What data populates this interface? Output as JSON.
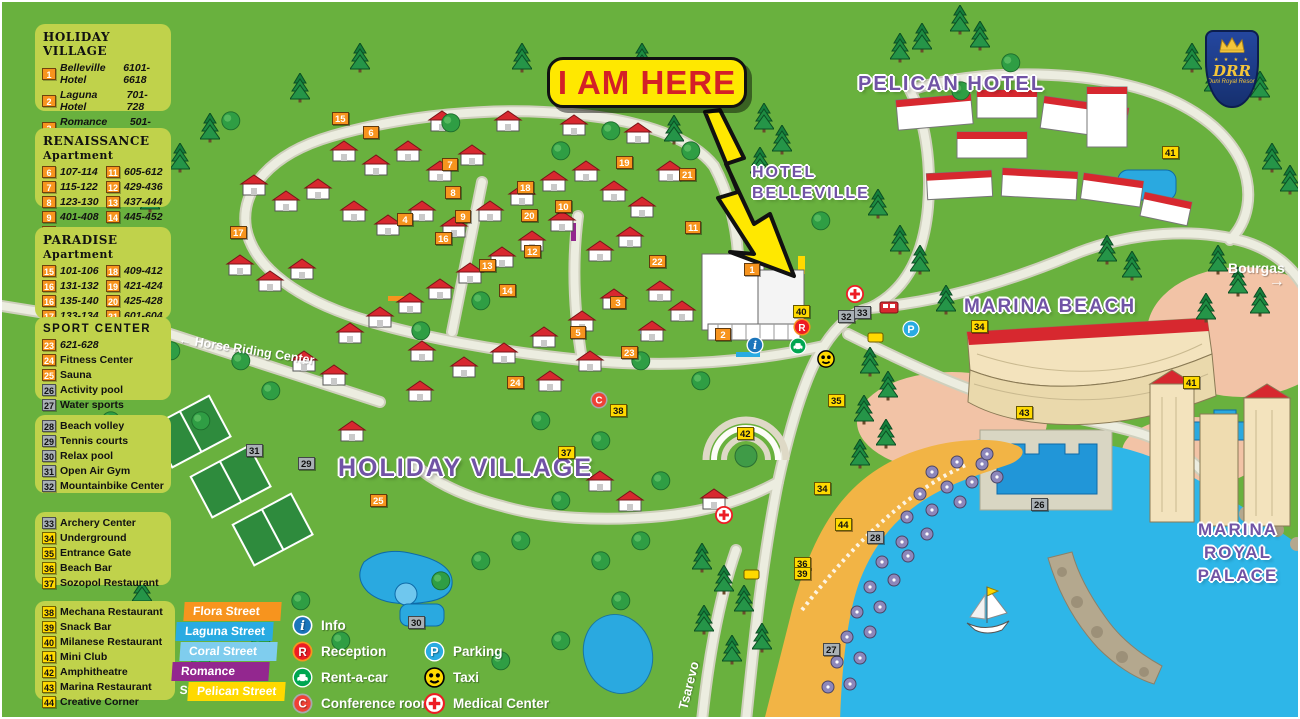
{
  "callout": {
    "text": "I AM HERE"
  },
  "logo": {
    "monogram": "DRR",
    "name": "Duni Royal Resort"
  },
  "colors": {
    "map_green": "#69b13e",
    "panel_bg": "#c0d24b",
    "badge_orange": "#f7941e",
    "badge_yellow": "#ffd900",
    "badge_gray": "#a9b0b5",
    "label_purple": "#7153a5",
    "sea": "#2eb6e8",
    "beach": "#f2b445"
  },
  "legend": {
    "panels": [
      {
        "id": "holiday-village",
        "box": {
          "x": 33,
          "y": 22,
          "w": 136,
          "h": 87
        },
        "title": "HOLIDAY VILLAGE",
        "serif": true,
        "columns": [
          [
            {
              "n": "1",
              "b": "o",
              "t": "Belleville Hotel",
              "v": "6101-6618",
              "i": 1
            },
            {
              "n": "2",
              "b": "o",
              "t": "Laguna Hotel",
              "v": "701-728",
              "i": 1
            },
            {
              "n": "3",
              "b": "o",
              "t": "Romance Hotel",
              "v": "501-554",
              "i": 1
            },
            {
              "n": "4",
              "b": "o",
              "t": "Flora Hotel",
              "v": "301-332",
              "i": 1
            },
            {
              "n": "5",
              "b": "o",
              "t": "Coral Hotel",
              "v": "201-251",
              "i": 1
            }
          ]
        ]
      },
      {
        "id": "renaissance-apartment",
        "box": {
          "x": 33,
          "y": 126,
          "w": 136,
          "h": 79
        },
        "title": "RENAISSANCE",
        "subtitle": "Apartment",
        "serif": true,
        "columns": [
          [
            {
              "n": "6",
              "b": "o",
              "t": "107-114",
              "i": 1
            },
            {
              "n": "7",
              "b": "o",
              "t": "115-122",
              "i": 1
            },
            {
              "n": "8",
              "b": "o",
              "t": "123-130",
              "i": 1
            },
            {
              "n": "9",
              "b": "o",
              "t": "401-408",
              "i": 1
            },
            {
              "n": "10",
              "b": "o",
              "t": "413-420",
              "i": 1
            }
          ],
          [
            {
              "n": "11",
              "b": "o",
              "t": "605-612",
              "i": 1
            },
            {
              "n": "12",
              "b": "o",
              "t": "429-436",
              "i": 1
            },
            {
              "n": "13",
              "b": "o",
              "t": "437-444",
              "i": 1
            },
            {
              "n": "14",
              "b": "o",
              "t": "445-452",
              "i": 1
            }
          ]
        ]
      },
      {
        "id": "paradise-apartment",
        "box": {
          "x": 33,
          "y": 225,
          "w": 136,
          "h": 92
        },
        "title": "PARADISE",
        "subtitle": "Apartment",
        "serif": true,
        "columns": [
          [
            {
              "n": "15",
              "b": "o",
              "t": "101-106",
              "i": 1
            },
            {
              "n": "16",
              "b": "o",
              "t": "131-132",
              "i": 1
            },
            {
              "n": "16",
              "b": "o",
              "t": "135-140",
              "i": 1
            },
            {
              "n": "17",
              "b": "o",
              "t": "133-134",
              "i": 1
            },
            {
              "n": "17",
              "b": "o",
              "t": "141-148",
              "i": 1
            }
          ],
          [
            {
              "n": "18",
              "b": "o",
              "t": "409-412",
              "i": 1
            },
            {
              "n": "19",
              "b": "o",
              "t": "421-424",
              "i": 1
            },
            {
              "n": "20",
              "b": "o",
              "t": "425-428",
              "i": 1
            },
            {
              "n": "21",
              "b": "o",
              "t": "601-604",
              "i": 1
            },
            {
              "n": "22",
              "b": "o",
              "t": "613-620",
              "i": 1
            }
          ]
        ]
      },
      {
        "id": "sport-center",
        "box": {
          "x": 33,
          "y": 315,
          "w": 136,
          "h": 83
        },
        "title": "SPORT CENTER",
        "serif": false,
        "columns": [
          [
            {
              "n": "23",
              "b": "o",
              "t": "621-628",
              "i": 1
            },
            {
              "n": "24",
              "b": "o",
              "t": "Fitness Center"
            },
            {
              "n": "25",
              "b": "o",
              "t": "Sauna"
            },
            {
              "n": "26",
              "b": "g",
              "t": "Activity pool"
            },
            {
              "n": "27",
              "b": "g",
              "t": "Water sports"
            }
          ]
        ]
      },
      {
        "id": "beach-facilities",
        "box": {
          "x": 33,
          "y": 413,
          "w": 136,
          "h": 78
        },
        "title": null,
        "columns": [
          [
            {
              "n": "28",
              "b": "g",
              "t": "Beach volley"
            },
            {
              "n": "29",
              "b": "g",
              "t": "Tennis courts"
            },
            {
              "n": "30",
              "b": "g",
              "t": "Relax pool"
            },
            {
              "n": "31",
              "b": "g",
              "t": "Open Air Gym"
            },
            {
              "n": "32",
              "b": "g",
              "t": "Mountainbike Center"
            }
          ]
        ]
      },
      {
        "id": "facilities",
        "box": {
          "x": 33,
          "y": 510,
          "w": 136,
          "h": 73
        },
        "title": null,
        "columns": [
          [
            {
              "n": "33",
              "b": "g",
              "t": "Archery Center"
            },
            {
              "n": "34",
              "b": "y",
              "t": "Underground"
            },
            {
              "n": "35",
              "b": "y",
              "t": "Entrance Gate"
            },
            {
              "n": "36",
              "b": "y",
              "t": "Beach Bar"
            },
            {
              "n": "37",
              "b": "y",
              "t": "Sozopol Restaurant"
            }
          ]
        ]
      },
      {
        "id": "restaurants",
        "box": {
          "x": 33,
          "y": 599,
          "w": 140,
          "h": 99
        },
        "title": null,
        "columns": [
          [
            {
              "n": "38",
              "b": "y",
              "t": "Mechana Restaurant"
            },
            {
              "n": "39",
              "b": "y",
              "t": "Snack Bar"
            },
            {
              "n": "40",
              "b": "y",
              "t": "Milanese Restaurant"
            },
            {
              "n": "41",
              "b": "y",
              "t": "Mini Club"
            },
            {
              "n": "42",
              "b": "y",
              "t": "Amphitheatre"
            },
            {
              "n": "43",
              "b": "y",
              "t": "Marina Restaurant"
            },
            {
              "n": "44",
              "b": "y",
              "t": "Creative Corner"
            }
          ]
        ]
      }
    ]
  },
  "streets": [
    {
      "name": "Flora Street",
      "color": "#f7941e"
    },
    {
      "name": "Laguna Street",
      "color": "#29abe2"
    },
    {
      "name": "Coral Street",
      "color": "#7fcdee"
    },
    {
      "name": "Romance Street",
      "color": "#93278f"
    },
    {
      "name": "Pelican Street",
      "color": "#ffd900"
    }
  ],
  "icon_legend": {
    "col1": [
      {
        "icon": "info",
        "label": "Info"
      },
      {
        "icon": "reception",
        "label": "Reception"
      },
      {
        "icon": "rentacar",
        "label": "Rent-a-car"
      },
      {
        "icon": "conference",
        "label": "Conference room"
      }
    ],
    "col2": [
      {
        "icon": "parking",
        "label": "Parking"
      },
      {
        "icon": "taxi",
        "label": "Taxi"
      },
      {
        "icon": "medical",
        "label": "Medical Center"
      }
    ]
  },
  "region_labels": [
    {
      "id": "pelican-hotel",
      "lines": [
        "PELICAN HOTEL"
      ],
      "x": 856,
      "y": 70,
      "size": 20,
      "lh": 24,
      "center": false
    },
    {
      "id": "hotel-belleville",
      "lines": [
        "HOTEL",
        "BELLEVILLE"
      ],
      "x": 750,
      "y": 160,
      "size": 16,
      "lh": 21,
      "center": false
    },
    {
      "id": "marina-beach",
      "lines": [
        "MARINA BEACH"
      ],
      "x": 962,
      "y": 294,
      "size": 19,
      "lh": 22,
      "center": false
    },
    {
      "id": "holiday-village",
      "lines": [
        "HOLIDAY VILLAGE"
      ],
      "x": 336,
      "y": 452,
      "size": 25,
      "lh": 28,
      "center": false
    },
    {
      "id": "marina-royal-palace",
      "lines": [
        "MARINA",
        "ROYAL",
        "PALACE"
      ],
      "x": 1184,
      "y": 516,
      "size": 17,
      "lh": 23,
      "center": true,
      "w": 104
    }
  ],
  "road_labels": [
    {
      "id": "bourgas",
      "text": "Bourgas",
      "x": 1226,
      "y": 258,
      "rotate": 0,
      "arrow": "right",
      "size": 14
    },
    {
      "id": "horse-riding-center",
      "text": "Horse Riding Center",
      "x": 176,
      "y": 330,
      "rotate": 9,
      "arrow": "left",
      "size": 12.5
    },
    {
      "id": "tsarevo",
      "text": "Tsarevo",
      "x": 688,
      "y": 694,
      "rotate": -76,
      "arrow": null,
      "size": 13
    }
  ],
  "markers": [
    {
      "n": "15",
      "c": "o",
      "x": 339,
      "y": 117
    },
    {
      "n": "6",
      "c": "o",
      "x": 370,
      "y": 131
    },
    {
      "n": "7",
      "c": "o",
      "x": 449,
      "y": 163
    },
    {
      "n": "8",
      "c": "o",
      "x": 452,
      "y": 191
    },
    {
      "n": "18",
      "c": "o",
      "x": 524,
      "y": 186
    },
    {
      "n": "20",
      "c": "o",
      "x": 528,
      "y": 214
    },
    {
      "n": "19",
      "c": "o",
      "x": 623,
      "y": 161
    },
    {
      "n": "21",
      "c": "o",
      "x": 686,
      "y": 173
    },
    {
      "n": "10",
      "c": "o",
      "x": 562,
      "y": 205
    },
    {
      "n": "11",
      "c": "o",
      "x": 692,
      "y": 226
    },
    {
      "n": "9",
      "c": "o",
      "x": 462,
      "y": 215
    },
    {
      "n": "16",
      "c": "o",
      "x": 442,
      "y": 237
    },
    {
      "n": "12",
      "c": "o",
      "x": 531,
      "y": 250
    },
    {
      "n": "13",
      "c": "o",
      "x": 486,
      "y": 264
    },
    {
      "n": "14",
      "c": "o",
      "x": 506,
      "y": 289
    },
    {
      "n": "17",
      "c": "o",
      "x": 237,
      "y": 231
    },
    {
      "n": "22",
      "c": "o",
      "x": 656,
      "y": 260
    },
    {
      "n": "4",
      "c": "o",
      "x": 404,
      "y": 218
    },
    {
      "n": "3",
      "c": "o",
      "x": 617,
      "y": 301
    },
    {
      "n": "5",
      "c": "o",
      "x": 577,
      "y": 331
    },
    {
      "n": "1",
      "c": "o",
      "x": 751,
      "y": 268
    },
    {
      "n": "2",
      "c": "o",
      "x": 722,
      "y": 333
    },
    {
      "n": "23",
      "c": "o",
      "x": 628,
      "y": 351
    },
    {
      "n": "24",
      "c": "o",
      "x": 514,
      "y": 381
    },
    {
      "n": "25",
      "c": "o",
      "x": 377,
      "y": 499
    },
    {
      "n": "26",
      "c": "g",
      "x": 1038,
      "y": 503
    },
    {
      "n": "27",
      "c": "g",
      "x": 830,
      "y": 648
    },
    {
      "n": "28",
      "c": "g",
      "x": 874,
      "y": 536
    },
    {
      "n": "29",
      "c": "g",
      "x": 305,
      "y": 462
    },
    {
      "n": "30",
      "c": "g",
      "x": 415,
      "y": 621
    },
    {
      "n": "31",
      "c": "g",
      "x": 253,
      "y": 449
    },
    {
      "n": "32",
      "c": "g",
      "x": 845,
      "y": 315
    },
    {
      "n": "33",
      "c": "g",
      "x": 861,
      "y": 311
    },
    {
      "n": "34",
      "c": "y",
      "x": 821,
      "y": 487
    },
    {
      "n": "34",
      "c": "y",
      "x": 978,
      "y": 325
    },
    {
      "n": "35",
      "c": "y",
      "x": 835,
      "y": 399
    },
    {
      "n": "36",
      "c": "y",
      "x": 801,
      "y": 562
    },
    {
      "n": "37",
      "c": "y",
      "x": 565,
      "y": 451
    },
    {
      "n": "38",
      "c": "y",
      "x": 617,
      "y": 409
    },
    {
      "n": "39",
      "c": "y",
      "x": 801,
      "y": 572
    },
    {
      "n": "40",
      "c": "y",
      "x": 800,
      "y": 310
    },
    {
      "n": "41",
      "c": "y",
      "x": 1169,
      "y": 151
    },
    {
      "n": "41",
      "c": "y",
      "x": 1190,
      "y": 381
    },
    {
      "n": "42",
      "c": "y",
      "x": 744,
      "y": 432
    },
    {
      "n": "43",
      "c": "y",
      "x": 1023,
      "y": 411
    },
    {
      "n": "44",
      "c": "y",
      "x": 842,
      "y": 523
    }
  ],
  "map_icons": [
    {
      "t": "info",
      "x": 753,
      "y": 343
    },
    {
      "t": "reception",
      "x": 800,
      "y": 325
    },
    {
      "t": "rentacar",
      "x": 796,
      "y": 344
    },
    {
      "t": "taxi",
      "x": 824,
      "y": 357
    },
    {
      "t": "parking",
      "x": 909,
      "y": 327
    },
    {
      "t": "conference",
      "x": 597,
      "y": 398
    },
    {
      "t": "medical",
      "x": 853,
      "y": 292
    },
    {
      "t": "medical",
      "x": 722,
      "y": 513
    }
  ]
}
